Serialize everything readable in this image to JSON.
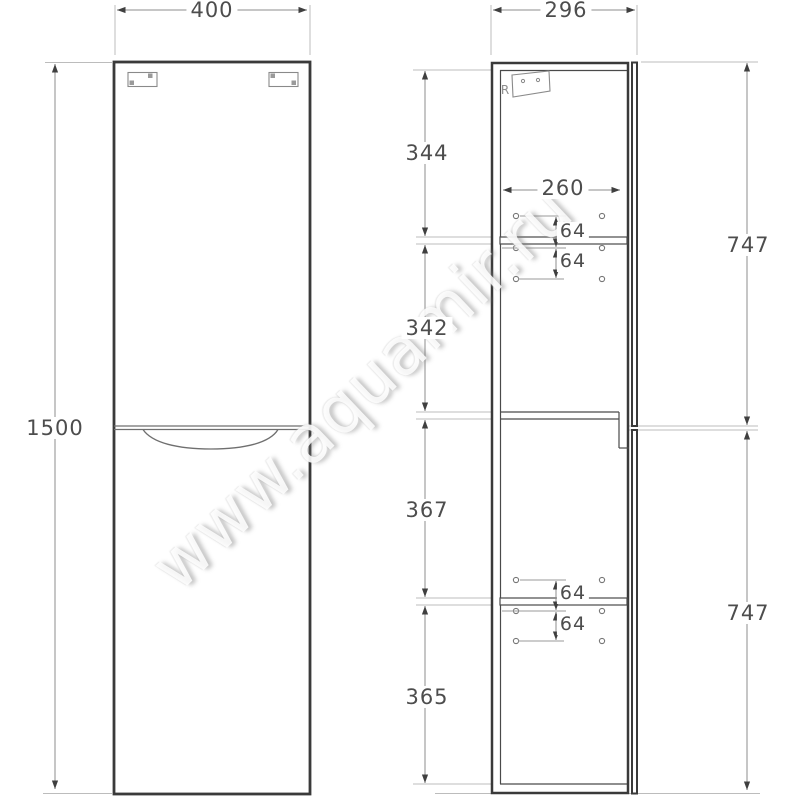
{
  "watermark": "www.aquamir.ru",
  "views": {
    "front": {
      "width": "400",
      "height": "1500"
    },
    "side": {
      "depth": "296",
      "interior_width": "260",
      "section_heights": [
        "344",
        "342",
        "367",
        "365"
      ],
      "door_heights": [
        "747",
        "747"
      ],
      "hole_spacings": [
        "64",
        "64",
        "64",
        "64"
      ],
      "bracket_mark": "R"
    }
  }
}
